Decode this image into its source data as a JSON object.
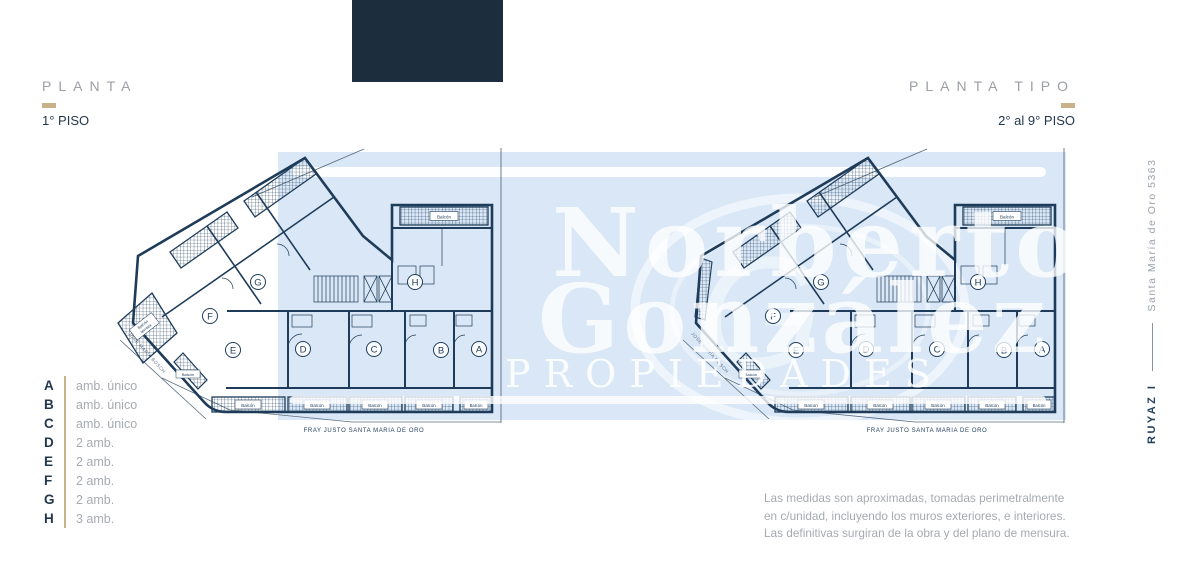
{
  "page": {
    "background": "#ffffff",
    "accent_gold": "#c9b189",
    "navy": "#21384e",
    "plan_line_color": "#1e3c5a"
  },
  "logo_block": {
    "color": "#1c2e3d"
  },
  "headers": {
    "left": {
      "title": "PLANTA",
      "subtitle": "1° PISO"
    },
    "right": {
      "title": "PLANTA TIPO",
      "subtitle": "2° al 9° PISO"
    }
  },
  "side_label": {
    "project": "RUYAZ I",
    "address": "Santa María de Oro 5363"
  },
  "watermark": {
    "word1": "Norberto",
    "word2": "González",
    "word3": "PROPIEDADES",
    "monogram": "G",
    "box_color": "#d9e7f6"
  },
  "plan": {
    "street_bottom": "FRAY JUSTO SANTA MARIA DE ORO",
    "street_side": "JOSÉ MARÍA BOSCH",
    "balcony_label": "Balcón",
    "terrace_label_line1": "Balcón",
    "terrace_label_line2": "terraza",
    "unit_letters": [
      "G",
      "F",
      "E",
      "H",
      "D",
      "C",
      "B",
      "A"
    ]
  },
  "legend": {
    "items": [
      {
        "letter": "A",
        "desc": "amb. único"
      },
      {
        "letter": "B",
        "desc": "amb. único"
      },
      {
        "letter": "C",
        "desc": "amb. único"
      },
      {
        "letter": "D",
        "desc": "2 amb."
      },
      {
        "letter": "E",
        "desc": "2 amb."
      },
      {
        "letter": "F",
        "desc": "2 amb."
      },
      {
        "letter": "G",
        "desc": "2 amb."
      },
      {
        "letter": "H",
        "desc": "3 amb."
      }
    ]
  },
  "disclaimer": {
    "line1": "Las medidas son aproximadas, tomadas perimetralmente",
    "line2": "en c/unidad, incluyendo los muros exteriores,  e interiores.",
    "line3": "Las definitivas surgiran de la obra y del plano de mensura."
  }
}
